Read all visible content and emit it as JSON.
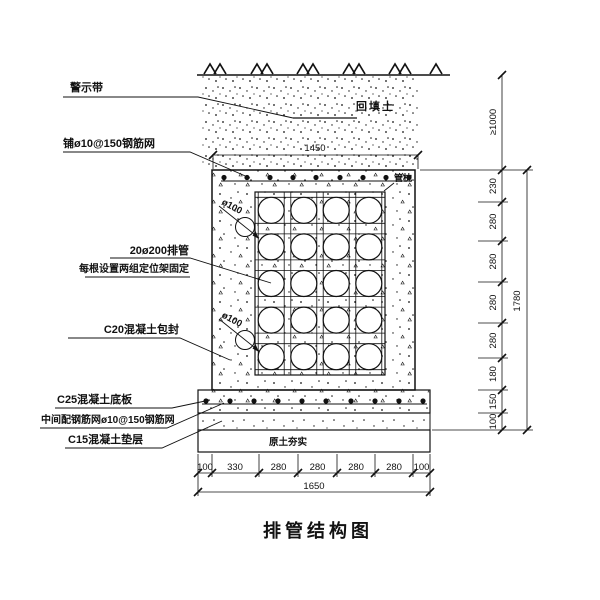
{
  "drawing_title": "排管结构图",
  "callouts": {
    "warning_tape": "警示带",
    "top_mesh": "铺ø10@150钢筋网",
    "pipes_line1": "20ø200排管",
    "pipes_line2": "每根设置两组定位架固定",
    "encasement": "C20混凝土包封",
    "base_slab": "C25混凝土底板",
    "slab_mesh": "中间配钢筋网ø10@150钢筋网",
    "cushion": "C15混凝土垫层",
    "backfill": "回填土",
    "pipe_pillow": "管枕",
    "compacted_soil": "原土夯实",
    "drain_pipe_top": "ø100",
    "drain_pipe_bottom": "ø100"
  },
  "dimensions": {
    "top_width": "1450",
    "cover_depth": "≥1000",
    "right_segments": [
      "230",
      "280",
      "280",
      "280",
      "280",
      "180",
      "150",
      "100"
    ],
    "right_total": "1780",
    "bottom_segments": [
      "100",
      "330",
      "280",
      "280",
      "280",
      "280",
      "100"
    ],
    "bottom_total": "1650"
  },
  "colors": {
    "line": "#111111",
    "background": "#ffffff"
  }
}
